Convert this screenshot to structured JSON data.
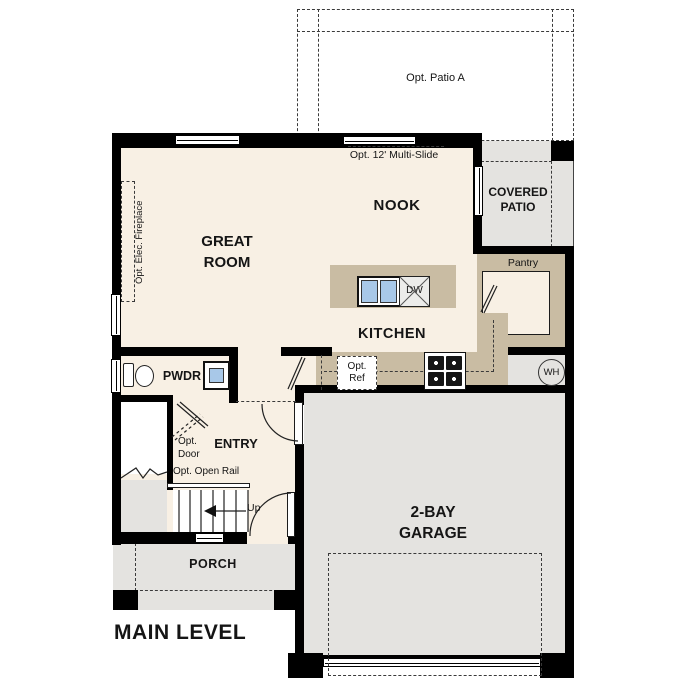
{
  "title": "MAIN LEVEL",
  "rooms": {
    "opt_patio": "Opt. Patio A",
    "covered_patio": "COVERED PATIO",
    "nook": "NOOK",
    "great_room": "GREAT ROOM",
    "kitchen": "KITCHEN",
    "pantry": "Pantry",
    "pwdr": "PWDR",
    "entry": "ENTRY",
    "garage": "2-BAY GARAGE",
    "porch": "PORCH"
  },
  "annotations": {
    "multi_slide": "Opt. 12' Multi-Slide",
    "fireplace": "Opt. Elec. Fireplace",
    "opt_ref": "Opt. Ref",
    "opt_door": "Opt. Door",
    "open_rail": "Opt. Open Rail",
    "up": "Up",
    "dishwasher": "DW",
    "water_heater": "WH"
  },
  "colors": {
    "interior_floor": "#F8F0E4",
    "exterior_concrete": "#E4E3E0",
    "casework_tan": "#C9BCA3",
    "fixture_blue": "#A8C8E8",
    "wall_black": "#000000"
  }
}
